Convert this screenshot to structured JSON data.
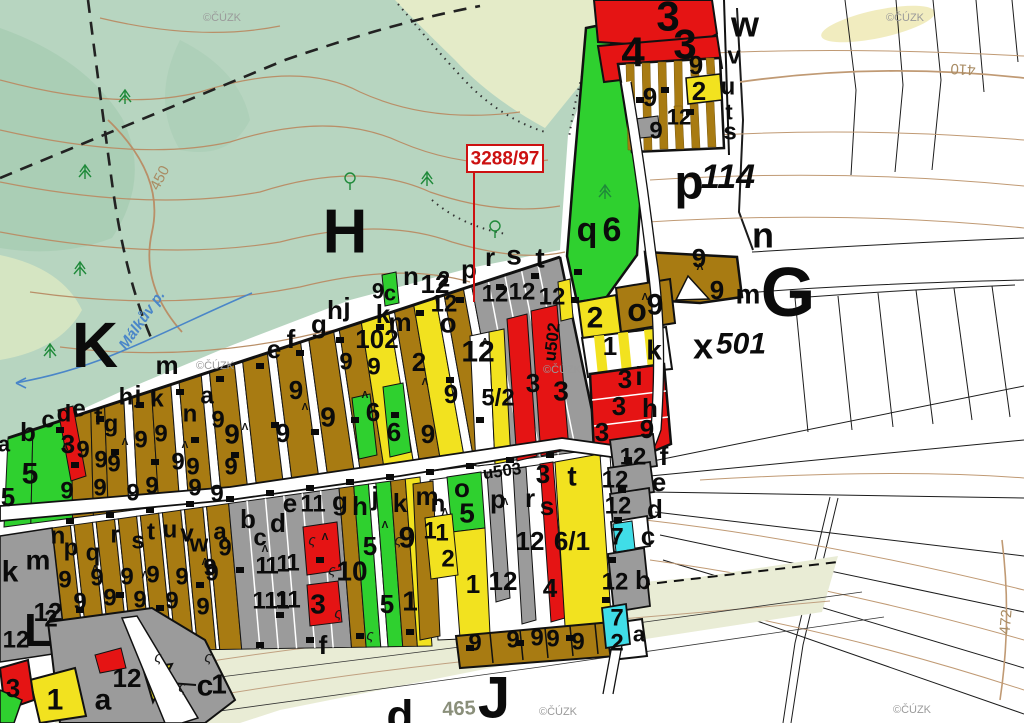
{
  "map_type": "cadastral-parcel-map",
  "source_watermark": "©ČÚZK",
  "callout": {
    "text": "3288/97",
    "color": "#cc1111"
  },
  "stream_label": {
    "t": "Málkův p.",
    "x": 142,
    "y": 320,
    "rot": -55
  },
  "contour_labels": [
    {
      "t": "450",
      "x": 160,
      "y": 178,
      "rot": -62
    },
    {
      "t": "410",
      "x": 963,
      "y": 69,
      "rot": 183
    },
    {
      "t": "472",
      "x": 1006,
      "y": 622,
      "rot": -85
    }
  ],
  "road_labels": [
    {
      "t": "u502",
      "x": 552,
      "y": 342,
      "rot": -83
    },
    {
      "t": "u503",
      "x": 502,
      "y": 471,
      "rot": -8
    },
    {
      "t": "465",
      "x": 459,
      "y": 709,
      "rot": -3
    }
  ],
  "watermark_positions": [
    [
      222,
      18
    ],
    [
      905,
      18
    ],
    [
      215,
      366
    ],
    [
      562,
      370
    ],
    [
      558,
      712
    ],
    [
      912,
      710
    ]
  ],
  "region_letters": [
    [
      "K",
      95,
      345,
      64
    ],
    [
      "H",
      345,
      232,
      62
    ],
    [
      "G",
      788,
      292,
      70
    ],
    [
      "J",
      494,
      698,
      58
    ],
    [
      "L",
      38,
      630,
      46
    ],
    [
      "d",
      400,
      716,
      44
    ]
  ],
  "labels": [
    [
      "3",
      668,
      16,
      42
    ],
    [
      "4",
      633,
      52,
      42
    ],
    [
      "3",
      685,
      44,
      42
    ],
    [
      "9",
      696,
      65,
      26
    ],
    [
      "2",
      699,
      91,
      26
    ],
    [
      "9",
      650,
      97,
      26
    ],
    [
      "12",
      679,
      117,
      22
    ],
    [
      "9",
      656,
      131,
      24
    ],
    [
      "w",
      745,
      24,
      36
    ],
    [
      "v",
      734,
      56,
      24
    ],
    [
      "u",
      728,
      87,
      24
    ],
    [
      "t",
      729,
      112,
      22
    ],
    [
      "s",
      730,
      132,
      24
    ],
    [
      "p",
      689,
      183,
      48
    ],
    [
      "114",
      728,
      177,
      34,
      "i"
    ],
    [
      "q",
      587,
      230,
      34
    ],
    [
      "6",
      612,
      230,
      34
    ],
    [
      "n",
      763,
      235,
      36
    ],
    [
      "m",
      748,
      294,
      28
    ],
    [
      "9",
      699,
      258,
      26
    ],
    [
      "9",
      717,
      290,
      26
    ],
    [
      "o",
      637,
      310,
      32
    ],
    [
      "9",
      655,
      305,
      30
    ],
    [
      "2",
      595,
      318,
      30
    ],
    [
      "1",
      610,
      346,
      26
    ],
    [
      "k",
      654,
      350,
      28
    ],
    [
      "x",
      703,
      346,
      36
    ],
    [
      "501",
      741,
      344,
      30,
      "i"
    ],
    [
      "3",
      625,
      379,
      26
    ],
    [
      "i",
      639,
      376,
      26
    ],
    [
      "3",
      619,
      406,
      26
    ],
    [
      "h",
      650,
      408,
      26
    ],
    [
      "3",
      602,
      432,
      26
    ],
    [
      "9",
      647,
      429,
      26
    ],
    [
      "3",
      533,
      383,
      26
    ],
    [
      "3",
      561,
      391,
      28
    ],
    [
      "a",
      4,
      444,
      22
    ],
    [
      "b",
      28,
      432,
      26
    ],
    [
      "5",
      30,
      474,
      30
    ],
    [
      "5",
      8,
      497,
      26
    ],
    [
      "c",
      48,
      420,
      24
    ],
    [
      "d",
      64,
      414,
      24
    ],
    [
      "3",
      68,
      444,
      26
    ],
    [
      "e",
      79,
      409,
      24
    ],
    [
      "9",
      83,
      450,
      24
    ],
    [
      "f",
      98,
      417,
      24
    ],
    [
      "g",
      111,
      424,
      24
    ],
    [
      "9",
      101,
      460,
      24
    ],
    [
      "9",
      114,
      464,
      24
    ],
    [
      "h",
      126,
      397,
      24
    ],
    [
      "j",
      138,
      395,
      24
    ],
    [
      "k",
      157,
      399,
      24
    ],
    [
      "9",
      141,
      440,
      24
    ],
    [
      "9",
      161,
      434,
      24
    ],
    [
      "9",
      178,
      462,
      24
    ],
    [
      "9",
      193,
      467,
      24
    ],
    [
      "m",
      167,
      365,
      26
    ],
    [
      "n",
      190,
      414,
      24
    ],
    [
      "a",
      207,
      396,
      24
    ],
    [
      "9",
      218,
      420,
      24
    ],
    [
      "9",
      231,
      467,
      24
    ],
    [
      "9",
      232,
      434,
      28
    ],
    [
      "9",
      283,
      433,
      26
    ],
    [
      "9",
      296,
      390,
      26
    ],
    [
      "9",
      328,
      417,
      28
    ],
    [
      "9",
      346,
      362,
      24
    ],
    [
      "9",
      374,
      367,
      24
    ],
    [
      "e",
      274,
      349,
      26
    ],
    [
      "f",
      291,
      339,
      26
    ],
    [
      "g",
      319,
      324,
      26
    ],
    [
      "h",
      335,
      310,
      26
    ],
    [
      "j",
      347,
      307,
      26
    ],
    [
      "k",
      383,
      314,
      26
    ],
    [
      "m",
      400,
      322,
      26
    ],
    [
      "o",
      448,
      323,
      28
    ],
    [
      "n",
      411,
      276,
      26
    ],
    [
      "12",
      435,
      284,
      26
    ],
    [
      "9",
      378,
      291,
      22
    ],
    [
      "c",
      390,
      293,
      22
    ],
    [
      "102",
      377,
      339,
      26
    ],
    [
      "2",
      419,
      362,
      26
    ],
    [
      "6",
      373,
      412,
      26
    ],
    [
      "6",
      394,
      432,
      26
    ],
    [
      "9",
      428,
      434,
      26
    ],
    [
      "9",
      451,
      394,
      26
    ],
    [
      "12",
      478,
      352,
      30
    ],
    [
      "5/2",
      498,
      398,
      24
    ],
    [
      "12",
      444,
      304,
      24
    ],
    [
      "12",
      495,
      294,
      24
    ],
    [
      "12",
      522,
      292,
      24
    ],
    [
      "12",
      552,
      297,
      24
    ],
    [
      "p",
      469,
      269,
      26
    ],
    [
      "r",
      490,
      257,
      26
    ],
    [
      "s",
      514,
      255,
      28
    ],
    [
      "t",
      540,
      258,
      28
    ],
    [
      "2",
      444,
      279,
      22
    ],
    [
      "9",
      67,
      491,
      24
    ],
    [
      "9",
      100,
      488,
      24
    ],
    [
      "9",
      133,
      493,
      24
    ],
    [
      "9",
      152,
      486,
      24
    ],
    [
      "9",
      195,
      488,
      24
    ],
    [
      "9",
      217,
      494,
      24
    ],
    [
      "k",
      10,
      572,
      30
    ],
    [
      "m",
      38,
      560,
      28
    ],
    [
      "12",
      48,
      612,
      26
    ],
    [
      "12",
      16,
      640,
      24
    ],
    [
      "n",
      58,
      536,
      24
    ],
    [
      "p",
      71,
      548,
      24
    ],
    [
      "q",
      93,
      553,
      24
    ],
    [
      "r",
      115,
      535,
      24
    ],
    [
      "s",
      138,
      541,
      24
    ],
    [
      "t",
      151,
      532,
      24
    ],
    [
      "u",
      170,
      530,
      24
    ],
    [
      "v",
      187,
      534,
      24
    ],
    [
      "w",
      199,
      544,
      24
    ],
    [
      "a",
      220,
      532,
      24
    ],
    [
      "9",
      65,
      580,
      24
    ],
    [
      "9",
      97,
      578,
      24
    ],
    [
      "9",
      127,
      577,
      24
    ],
    [
      "9",
      153,
      575,
      24
    ],
    [
      "9",
      182,
      577,
      24
    ],
    [
      "9",
      212,
      573,
      24
    ],
    [
      "9",
      80,
      602,
      24
    ],
    [
      "9",
      110,
      598,
      24
    ],
    [
      "9",
      140,
      600,
      24
    ],
    [
      "9",
      172,
      601,
      24
    ],
    [
      "9",
      203,
      607,
      24
    ],
    [
      "2",
      51,
      619,
      24
    ],
    [
      "b",
      248,
      519,
      26
    ],
    [
      "c",
      260,
      538,
      24
    ],
    [
      "d",
      278,
      523,
      26
    ],
    [
      "e",
      290,
      503,
      26
    ],
    [
      "11",
      313,
      504,
      24
    ],
    [
      "g",
      340,
      501,
      26
    ],
    [
      "h",
      360,
      506,
      26
    ],
    [
      "j",
      375,
      496,
      26
    ],
    [
      "k",
      400,
      503,
      26
    ],
    [
      "m",
      427,
      496,
      26
    ],
    [
      "n",
      438,
      504,
      24
    ],
    [
      "o",
      462,
      488,
      26
    ],
    [
      "5",
      467,
      513,
      28
    ],
    [
      "9",
      407,
      538,
      30
    ],
    [
      "1",
      262,
      566,
      24
    ],
    [
      "1",
      272,
      566,
      24
    ],
    [
      "1",
      283,
      564,
      24
    ],
    [
      "1",
      293,
      563,
      24
    ],
    [
      "10",
      352,
      571,
      28
    ],
    [
      "5",
      370,
      546,
      26
    ],
    [
      "11",
      265,
      601,
      24
    ],
    [
      "11",
      277,
      601,
      24
    ],
    [
      "11",
      288,
      600,
      24
    ],
    [
      "3",
      318,
      604,
      28
    ],
    [
      "1",
      410,
      601,
      28
    ],
    [
      "5",
      387,
      604,
      26
    ],
    [
      "9",
      210,
      568,
      24
    ],
    [
      "9",
      225,
      548,
      24
    ],
    [
      "f",
      323,
      645,
      26
    ],
    [
      "1",
      430,
      531,
      24
    ],
    [
      "1",
      442,
      533,
      24
    ],
    [
      "2",
      448,
      559,
      24
    ],
    [
      "3",
      543,
      474,
      26
    ],
    [
      "t",
      572,
      476,
      28
    ],
    [
      "p",
      498,
      499,
      26
    ],
    [
      "r",
      530,
      498,
      26
    ],
    [
      "s",
      547,
      506,
      26
    ],
    [
      "12",
      530,
      541,
      26
    ],
    [
      "6/1",
      572,
      541,
      26
    ],
    [
      "1",
      473,
      584,
      26
    ],
    [
      "12",
      503,
      581,
      26
    ],
    [
      "4",
      550,
      588,
      26
    ],
    [
      "9",
      475,
      643,
      24
    ],
    [
      "9",
      513,
      640,
      24
    ],
    [
      "9",
      537,
      638,
      24
    ],
    [
      "9",
      553,
      639,
      24
    ],
    [
      "9",
      578,
      642,
      24
    ],
    [
      "2",
      617,
      643,
      24
    ],
    [
      "a",
      639,
      634,
      22
    ],
    [
      "3",
      13,
      688,
      26
    ],
    [
      "1",
      55,
      700,
      30
    ],
    [
      "a",
      103,
      700,
      30
    ],
    [
      "12",
      127,
      678,
      26
    ],
    [
      "c",
      205,
      686,
      30
    ],
    [
      "1",
      219,
      684,
      28
    ],
    [
      "12",
      633,
      457,
      24
    ],
    [
      "f",
      664,
      456,
      26
    ],
    [
      "12",
      615,
      480,
      24
    ],
    [
      "e",
      659,
      482,
      26
    ],
    [
      "12",
      618,
      506,
      24
    ],
    [
      "d",
      655,
      509,
      26
    ],
    [
      "7",
      617,
      537,
      24
    ],
    [
      "c",
      648,
      536,
      26
    ],
    [
      "12",
      615,
      582,
      24
    ],
    [
      "b",
      643,
      580,
      26
    ],
    [
      "7",
      617,
      618,
      24
    ]
  ],
  "colors": {
    "orchard_brown": "#a87b12",
    "grassland_gray": "#9b9b9b",
    "building_red": "#e51414",
    "garden_yellow": "#f2e21f",
    "meadow_green": "#2fd02f",
    "water_cyan": "#40dde8",
    "forest_topo": "#b7d5c0",
    "contour_brown": "#b98f68",
    "callout_red": "#cc1111"
  }
}
